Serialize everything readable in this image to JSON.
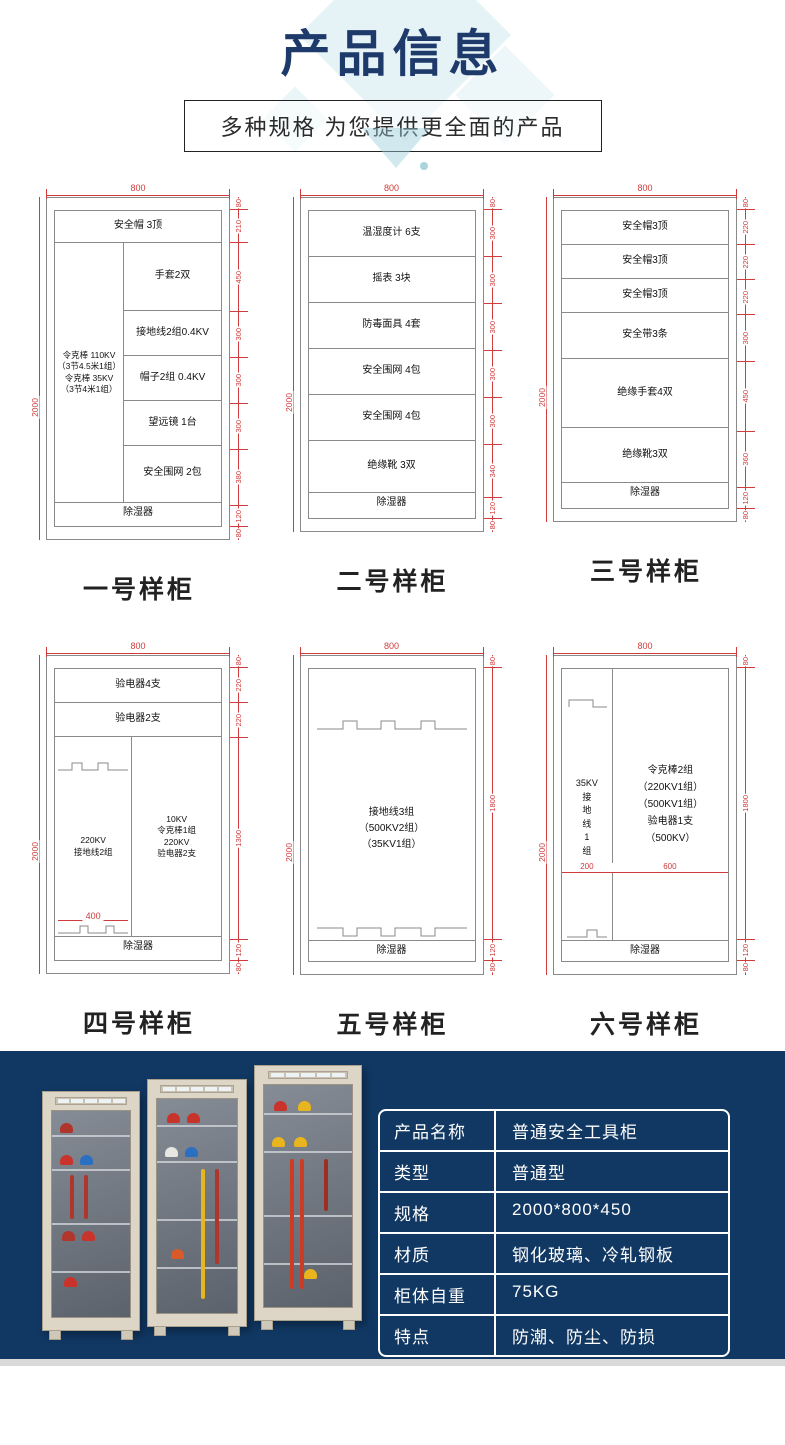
{
  "header": {
    "title": "产品信息",
    "subtitle": "多种规格  为您提供更全面的产品"
  },
  "colors": {
    "accent_navy": "#1d3a6a",
    "dimension_red": "#d03b3b",
    "footer_bg": "#113863"
  },
  "cabinets": [
    {
      "name": "一号样柜",
      "width_dim": "800",
      "height_dim": "2000",
      "shelf1": "安全帽  3顶",
      "left_col": {
        "l1": "令克棒  110KV",
        "l2": "（3节4.5米1组）",
        "l3": "令克棒  35KV",
        "l4": "（3节4米1组）"
      },
      "right_shelves": {
        "s1": "手套2双",
        "s2": "接地线2组0.4KV",
        "s3": "帽子2组 0.4KV",
        "s4": "望远镜 1台",
        "s5": "安全围网 2包"
      },
      "dehumidifier": "除湿器",
      "right_dims": [
        "80",
        "210",
        "450",
        "300",
        "300",
        "300",
        "380",
        "120",
        "80"
      ]
    },
    {
      "name": "二号样柜",
      "width_dim": "800",
      "height_dim": "2000",
      "shelves": [
        "温湿度计  6支",
        "摇表  3块",
        "防毒面具  4套",
        "安全围网  4包",
        "安全围网  4包",
        "绝缘靴  3双"
      ],
      "dehumidifier": "除湿器",
      "right_dims": [
        "80",
        "300",
        "300",
        "300",
        "300",
        "300",
        "340",
        "120",
        "80"
      ]
    },
    {
      "name": "三号样柜",
      "width_dim": "800",
      "height_dim": "2000",
      "shelves": [
        "安全帽3顶",
        "安全帽3顶",
        "安全帽3顶",
        "安全带3条",
        "绝缘手套4双",
        "绝缘靴3双"
      ],
      "dehumidifier": "除湿器",
      "right_dims": [
        "80",
        "220",
        "220",
        "220",
        "300",
        "450",
        "360",
        "120",
        "80"
      ]
    },
    {
      "name": "四号样柜",
      "width_dim": "800",
      "height_dim": "2000",
      "shelf1": "验电器4支",
      "shelf2": "验电器2支",
      "left_col": {
        "l1": "220KV",
        "l2": "接地线2组"
      },
      "right_col": {
        "l1": "10KV",
        "l2": "令克棒1组",
        "l3": "220KV",
        "l4": "验电器2支"
      },
      "inner_width_dim": "400",
      "dehumidifier": "除湿器",
      "right_dims": [
        "80",
        "220",
        "220",
        "1300",
        "120",
        "80"
      ]
    },
    {
      "name": "五号样柜",
      "width_dim": "800",
      "height_dim": "2000",
      "center": {
        "l1": "接地线3组",
        "l2": "（500KV2组）",
        "l3": "（35KV1组）"
      },
      "dehumidifier": "除湿器",
      "right_dims": [
        "80",
        "1800",
        "120",
        "80"
      ]
    },
    {
      "name": "六号样柜",
      "width_dim": "800",
      "height_dim": "2000",
      "left_col": {
        "l1": "35KV",
        "l2": "接",
        "l3": "地",
        "l4": "线",
        "l5": "1",
        "l6": "组"
      },
      "right_col": {
        "l1": "令克棒2组",
        "l2": "（220KV1组）",
        "l3": "（500KV1组）",
        "l4": "验电器1支",
        "l5": "（500KV）"
      },
      "bottom_dims": {
        "left": "200",
        "right": "600"
      },
      "dehumidifier": "除湿器",
      "right_dims": [
        "80",
        "1800",
        "120",
        "80"
      ]
    }
  ],
  "spec_table": {
    "rows": [
      {
        "label": "产品名称",
        "value": "普通安全工具柜"
      },
      {
        "label": "类型",
        "value": "普通型"
      },
      {
        "label": "规格",
        "value": "2000*800*450"
      },
      {
        "label": "材质",
        "value": "钢化玻璃、冷轧钢板"
      },
      {
        "label": "柜体自重",
        "value": "75KG"
      },
      {
        "label": "特点",
        "value": "防潮、防尘、防损"
      }
    ]
  }
}
